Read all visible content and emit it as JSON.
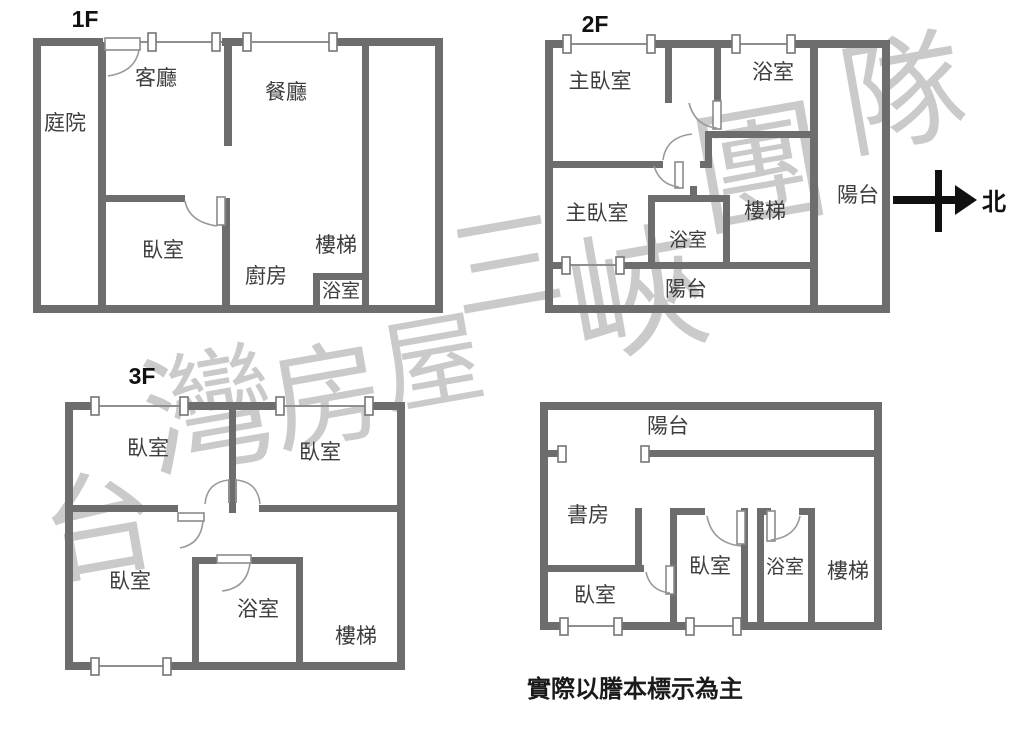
{
  "note": {
    "text": "實際以謄本標示為主"
  },
  "compass": {
    "north_label": "北"
  },
  "watermark": {
    "text": "台灣房屋三峽團隊",
    "chars": [
      "台",
      "灣",
      "房",
      "屋",
      "三",
      "峽",
      "團",
      "隊"
    ]
  },
  "colors": {
    "wall": "#6d6d6d",
    "room_label": "#3d3d3d",
    "watermark": "#c8c8c8",
    "ink": "#111111"
  },
  "floors": [
    {
      "label": "1F",
      "rooms": [
        {
          "name": "courtyard",
          "label": "庭院"
        },
        {
          "name": "living-room",
          "label": "客廳"
        },
        {
          "name": "dining-room",
          "label": "餐廳"
        },
        {
          "name": "bedroom",
          "label": "臥室"
        },
        {
          "name": "kitchen",
          "label": "廚房"
        },
        {
          "name": "stairs",
          "label": "樓梯"
        },
        {
          "name": "bathroom",
          "label": "浴室"
        }
      ]
    },
    {
      "label": "2F",
      "rooms": [
        {
          "name": "master-bedroom-top",
          "label": "主臥室"
        },
        {
          "name": "bathroom-top",
          "label": "浴室"
        },
        {
          "name": "master-bedroom-bottom",
          "label": "主臥室"
        },
        {
          "name": "bathroom-center",
          "label": "浴室"
        },
        {
          "name": "stairs",
          "label": "樓梯"
        },
        {
          "name": "balcony-right",
          "label": "陽台"
        },
        {
          "name": "balcony-bottom",
          "label": "陽台"
        }
      ]
    },
    {
      "label": "3F",
      "rooms": [
        {
          "name": "bedroom-top-left",
          "label": "臥室"
        },
        {
          "name": "bedroom-top-right",
          "label": "臥室"
        },
        {
          "name": "bedroom-bottom-left",
          "label": "臥室"
        },
        {
          "name": "bathroom",
          "label": "浴室"
        },
        {
          "name": "stairs",
          "label": "樓梯"
        }
      ]
    },
    {
      "label": "",
      "rooms": [
        {
          "name": "balcony",
          "label": "陽台"
        },
        {
          "name": "study",
          "label": "書房"
        },
        {
          "name": "bedroom-left",
          "label": "臥室"
        },
        {
          "name": "bedroom-center",
          "label": "臥室"
        },
        {
          "name": "bathroom",
          "label": "浴室"
        },
        {
          "name": "stairs",
          "label": "樓梯"
        }
      ]
    }
  ]
}
